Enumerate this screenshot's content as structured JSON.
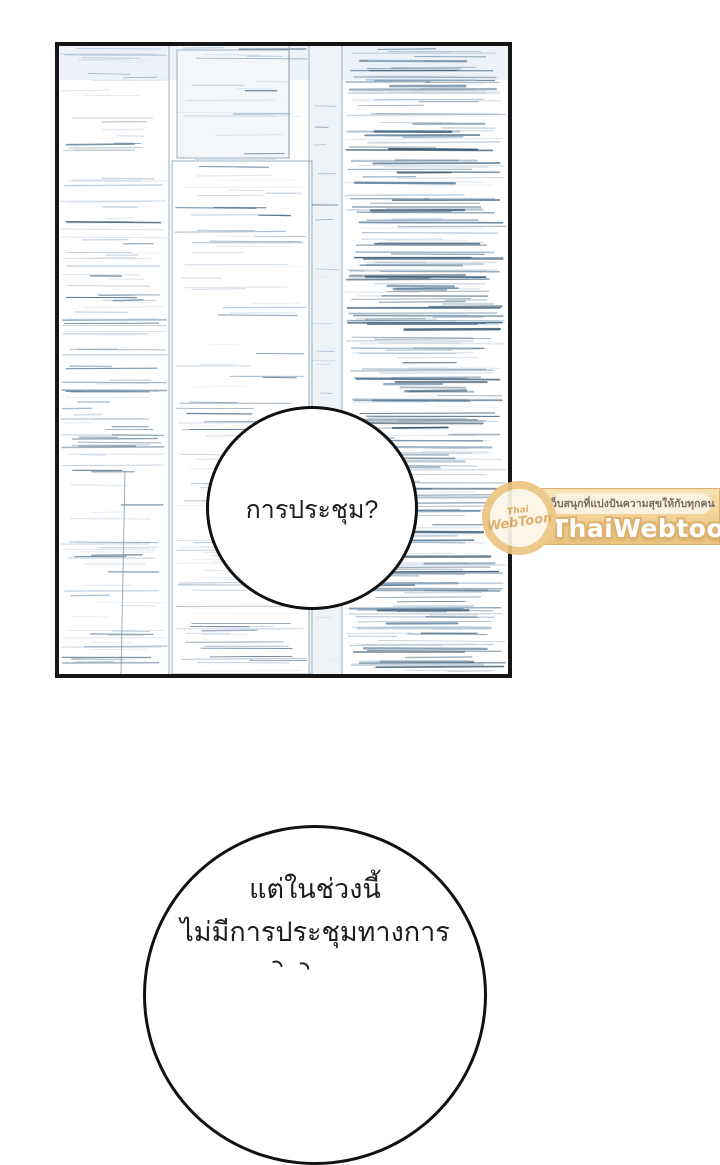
{
  "page": {
    "background": "#ffffff"
  },
  "panel": {
    "border_color": "#161616"
  },
  "bubbles": {
    "top": {
      "text": "การประชุม?"
    },
    "bottom": {
      "line1": "แต่ในช่วงนี้",
      "line2": "ไม่มีการประชุมทางการ"
    }
  },
  "watermark": {
    "badge_line1": "Thai",
    "badge_line2": "WebToon",
    "tagline": "เว็บสนุกที่แบ่งปันความสุขให้กับทุกคน",
    "brand": "ThaiWebtoon",
    "colors": {
      "ribbon": "#eac178",
      "ribbon_light": "#f7e2b0",
      "pill": "#faf2da",
      "tagline_text": "#6b6254",
      "brand_text": "#ffffff",
      "brand_outline": "#dcae67",
      "badge_ring": "#ecc584",
      "badge_bg": "#fcf6e7",
      "badge_text": "#dfab63"
    }
  },
  "texture": {
    "seed": 20240613,
    "palette": [
      "#d3dde7",
      "#b9c9d8",
      "#9cb2c6",
      "#7b96ae",
      "#5d7e9a",
      "#43647f",
      "#33516a"
    ],
    "line_color": "#7e95a9",
    "tints": [
      {
        "x": 0,
        "y": 0,
        "w": 449,
        "h": 34,
        "c": "#edf2f8"
      },
      {
        "x": 250,
        "y": 0,
        "w": 33,
        "h": 628,
        "c": "#eef3f8"
      },
      {
        "x": 118,
        "y": 0,
        "w": 112,
        "h": 112,
        "c": "#f3f7fa"
      }
    ],
    "regions": [
      {
        "name": "left",
        "x": 2,
        "w": 106,
        "y": 2,
        "h": 624,
        "count": 135,
        "minLen": 25,
        "maxLen": 105,
        "bias": 1.6,
        "wMin": 0.6,
        "wMax": 1.6
      },
      {
        "name": "middle",
        "x": 116,
        "w": 132,
        "y": 2,
        "h": 624,
        "count": 120,
        "minLen": 30,
        "maxLen": 128,
        "bias": 1.9,
        "wMin": 0.5,
        "wMax": 1.4
      },
      {
        "name": "narrow",
        "x": 252,
        "w": 28,
        "y": 2,
        "h": 624,
        "count": 28,
        "minLen": 8,
        "maxLen": 26,
        "bias": 2.2,
        "wMin": 0.5,
        "wMax": 1.2
      },
      {
        "name": "right",
        "x": 286,
        "w": 161,
        "y": 2,
        "h": 624,
        "count": 215,
        "minLen": 40,
        "maxLen": 158,
        "bias": 1.0,
        "wMin": 0.6,
        "wMax": 1.9
      },
      {
        "name": "right-dark",
        "x": 290,
        "w": 155,
        "y": 4,
        "h": 620,
        "count": 72,
        "minLen": 50,
        "maxLen": 148,
        "bias": 0.55,
        "wMin": 1.2,
        "wMax": 2.6
      }
    ],
    "lines": [
      {
        "x1": 110,
        "y1": 0,
        "x2": 110,
        "y2": 628
      },
      {
        "x1": 250,
        "y1": 0,
        "x2": 250,
        "y2": 628
      },
      {
        "x1": 283,
        "y1": 0,
        "x2": 283,
        "y2": 628
      },
      {
        "x1": 230,
        "y1": 0,
        "x2": 230,
        "y2": 112
      },
      {
        "x1": 66,
        "y1": 425,
        "x2": 62,
        "y2": 628
      }
    ],
    "rects": [
      {
        "x": 118,
        "y": 4,
        "w": 112,
        "h": 108
      },
      {
        "x": 113,
        "y": 115,
        "w": 140,
        "h": 513
      }
    ]
  }
}
